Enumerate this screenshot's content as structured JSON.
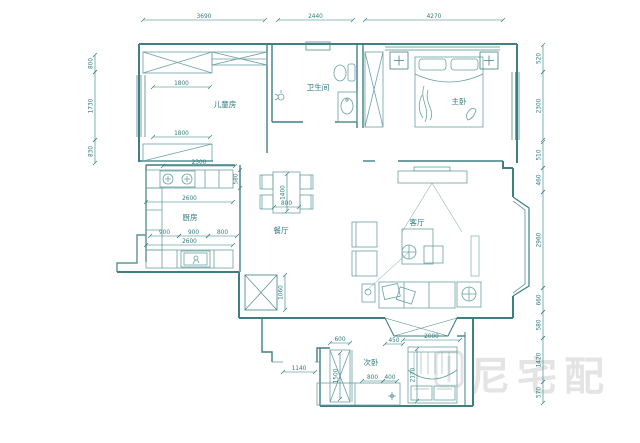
{
  "watermark": {
    "text": "尼宅配"
  },
  "rooms": [
    {
      "label": "儿童房",
      "x": 225,
      "y": 107
    },
    {
      "label": "卫生间",
      "x": 318,
      "y": 90
    },
    {
      "label": "主卧",
      "x": 459,
      "y": 104
    },
    {
      "label": "厨房",
      "x": 190,
      "y": 220
    },
    {
      "label": "餐厅",
      "x": 281,
      "y": 233
    },
    {
      "label": "客厅",
      "x": 417,
      "y": 225
    },
    {
      "label": "次卧",
      "x": 371,
      "y": 365
    }
  ],
  "dimensions": [
    {
      "v": "3690",
      "o": "h",
      "x1": 143,
      "x2": 265,
      "y": 20
    },
    {
      "v": "2440",
      "o": "h",
      "x1": 278,
      "x2": 353,
      "y": 20
    },
    {
      "v": "4270",
      "o": "h",
      "x1": 365,
      "x2": 503,
      "y": 20
    },
    {
      "v": "800",
      "o": "v",
      "x": 95,
      "y1": 55,
      "y2": 72
    },
    {
      "v": "1730",
      "o": "v",
      "x": 95,
      "y1": 72,
      "y2": 140
    },
    {
      "v": "830",
      "o": "v",
      "x": 95,
      "y1": 140,
      "y2": 163
    },
    {
      "v": "520",
      "o": "v",
      "x": 543,
      "y1": 45,
      "y2": 72
    },
    {
      "v": "2300",
      "o": "v",
      "x": 543,
      "y1": 72,
      "y2": 140
    },
    {
      "v": "510",
      "o": "v",
      "x": 543,
      "y1": 142,
      "y2": 168
    },
    {
      "v": "460",
      "o": "v",
      "x": 543,
      "y1": 168,
      "y2": 192
    },
    {
      "v": "2960",
      "o": "v",
      "x": 543,
      "y1": 192,
      "y2": 288
    },
    {
      "v": "660",
      "o": "v",
      "x": 543,
      "y1": 288,
      "y2": 312
    },
    {
      "v": "580",
      "o": "v",
      "x": 543,
      "y1": 312,
      "y2": 338
    },
    {
      "v": "1420",
      "o": "v",
      "x": 543,
      "y1": 338,
      "y2": 382
    },
    {
      "v": "570",
      "o": "v",
      "x": 543,
      "y1": 382,
      "y2": 403
    },
    {
      "v": "1800",
      "o": "h",
      "x1": 153,
      "x2": 210,
      "y": 87
    },
    {
      "v": "1800",
      "o": "h",
      "x1": 153,
      "x2": 210,
      "y": 137
    },
    {
      "v": "2300",
      "o": "h",
      "x1": 163,
      "x2": 235,
      "y": 166
    },
    {
      "v": "580",
      "o": "v",
      "x": 240,
      "y1": 170,
      "y2": 188
    },
    {
      "v": "2600",
      "o": "h",
      "x1": 146,
      "x2": 233,
      "y": 202
    },
    {
      "v": "900",
      "o": "h",
      "x1": 150,
      "x2": 179,
      "y": 236
    },
    {
      "v": "900",
      "o": "h",
      "x1": 179,
      "x2": 208,
      "y": 236
    },
    {
      "v": "800",
      "o": "h",
      "x1": 208,
      "x2": 237,
      "y": 236
    },
    {
      "v": "2600",
      "o": "h",
      "x1": 146,
      "x2": 233,
      "y": 245
    },
    {
      "v": "1400",
      "o": "v",
      "x": 287,
      "y1": 174,
      "y2": 211
    },
    {
      "v": "800",
      "o": "h",
      "x1": 274,
      "x2": 299,
      "y": 207
    },
    {
      "v": "1060",
      "o": "v",
      "x": 285,
      "y1": 275,
      "y2": 310
    },
    {
      "v": "1140",
      "o": "h",
      "x1": 283,
      "x2": 315,
      "y": 372
    },
    {
      "v": "600",
      "o": "h",
      "x1": 330,
      "x2": 350,
      "y": 343
    },
    {
      "v": "1500",
      "o": "v",
      "x": 340,
      "y1": 353,
      "y2": 399
    },
    {
      "v": "450",
      "o": "h",
      "x1": 385,
      "x2": 403,
      "y": 344
    },
    {
      "v": "2000",
      "o": "h",
      "x1": 403,
      "x2": 460,
      "y": 340
    },
    {
      "v": "2170",
      "o": "v",
      "x": 417,
      "y1": 349,
      "y2": 401
    },
    {
      "v": "800",
      "o": "h",
      "x1": 362,
      "x2": 383,
      "y": 381
    },
    {
      "v": "400",
      "o": "h",
      "x1": 383,
      "x2": 397,
      "y": 381
    }
  ]
}
